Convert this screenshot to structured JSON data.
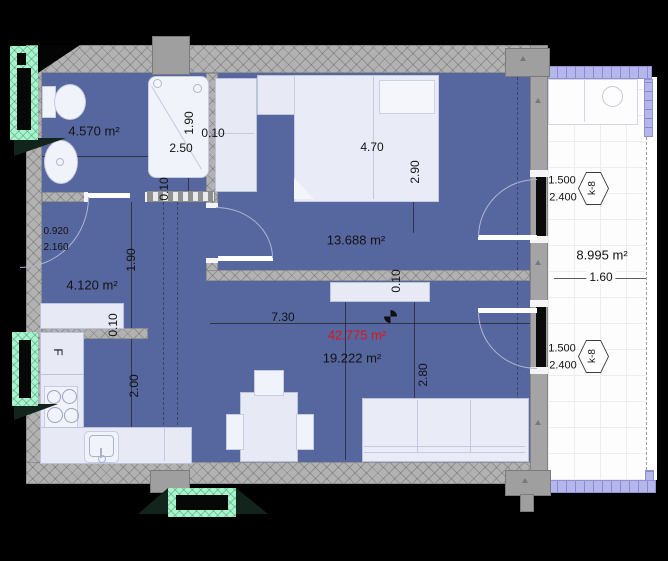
{
  "labels": {
    "bathroom_area": "4.570 m²",
    "hall_area": "4.120 m²",
    "bedroom_area": "13.688 m²",
    "living_area": "19.222 m²",
    "total_area": "42.775 m²",
    "balcony_area": "8.995 m²",
    "dim_bath_width": "2.50",
    "dim_bath_height": "1.90",
    "dim_hall_height": "1.90",
    "dim_bed_width": "4.70",
    "dim_bed_height": "2.90",
    "dim_living_width": "7.30",
    "dim_living_height": "2.80",
    "dim_kitchen_height": "2.00",
    "dim_balcony_width": "1.60",
    "wall_thickness": "0.10",
    "door_width": "0.920",
    "door_height": "2.160",
    "window_width": "1.500",
    "window_height": "2.400",
    "window_code": "k-8",
    "fridge": "F"
  },
  "colors": {
    "floor": "#56669e",
    "wall": "#b2b2b2",
    "furniture": "#e7eaf5",
    "balcony_rail": "#b5b7ec",
    "window_frame": "#a9f4cd",
    "total_area_text": "#e01414"
  }
}
